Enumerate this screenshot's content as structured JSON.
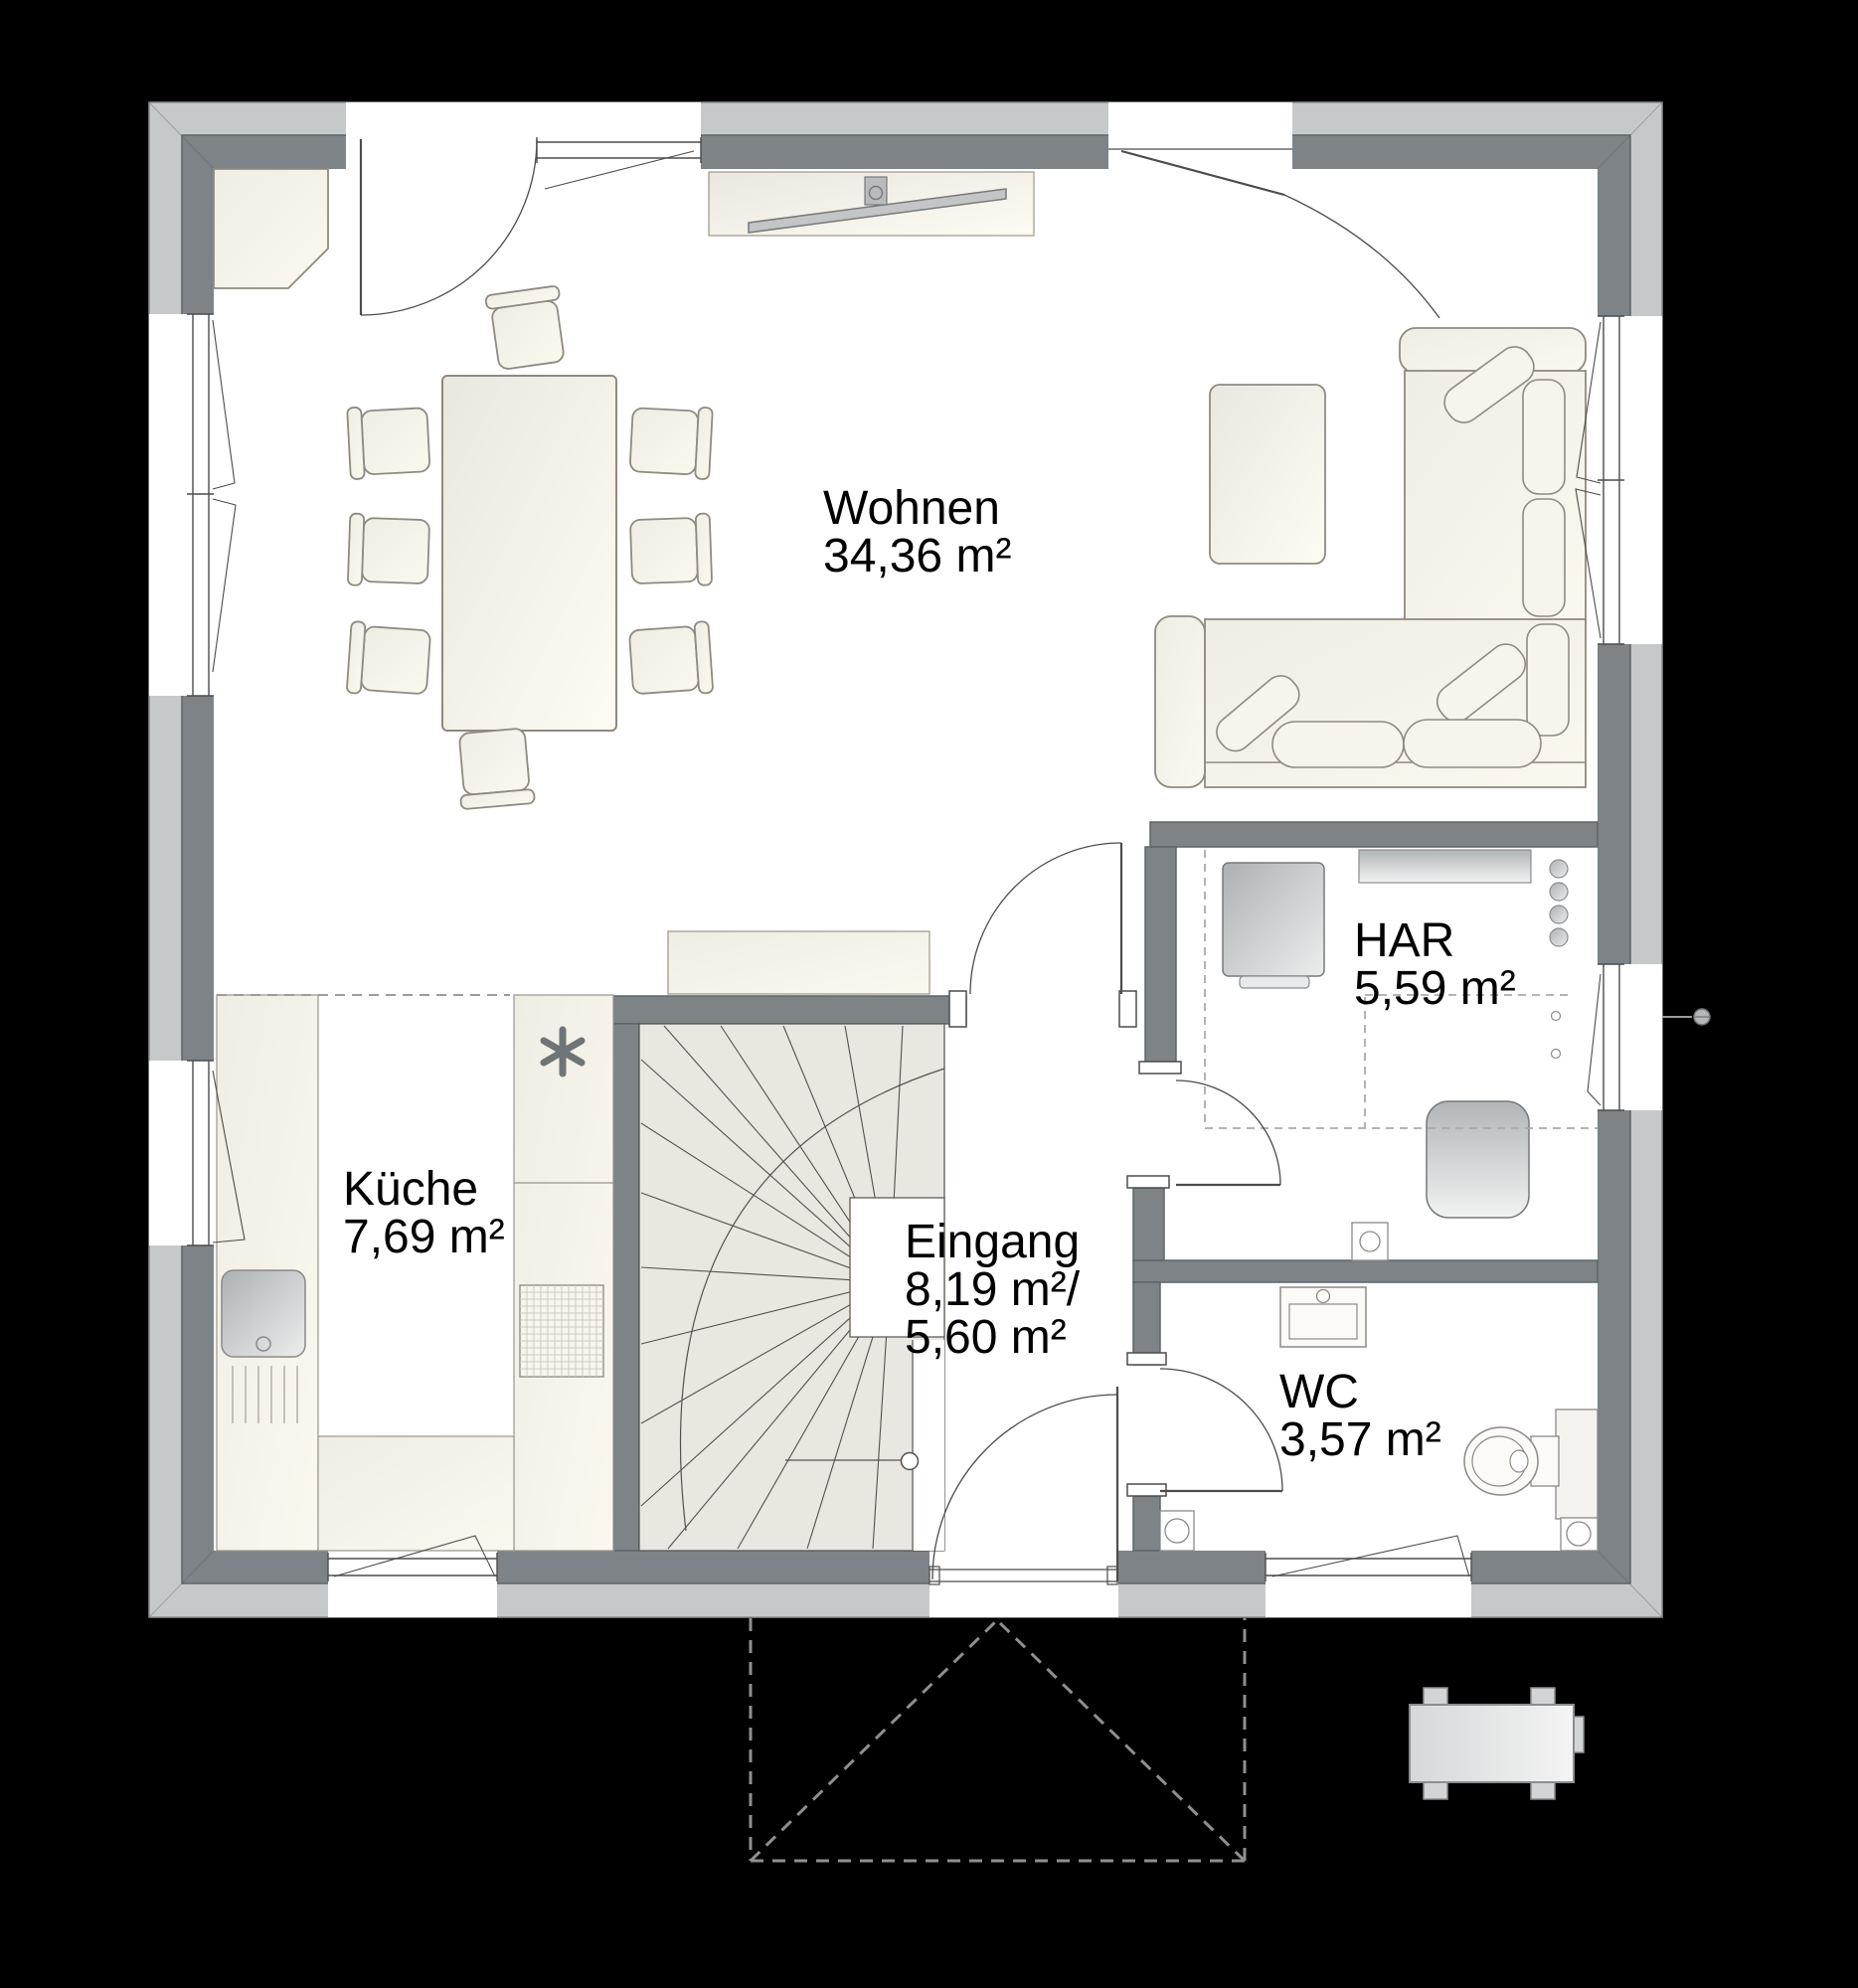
{
  "plan": {
    "type": "floor-plan-ground-floor",
    "rooms": [
      {
        "id": "wohnen",
        "name": "Wohnen",
        "area": "34,36 m²"
      },
      {
        "id": "kueche",
        "name": "Küche",
        "area": "7,69 m²"
      },
      {
        "id": "eingang",
        "name": "Eingang",
        "area_with_stairs": "8,19 m²/",
        "area_without_stairs": "5,60 m²"
      },
      {
        "id": "har",
        "name": "HAR",
        "area": "5,59 m²"
      },
      {
        "id": "wc",
        "name": "WC",
        "area": "3,57 m²"
      }
    ],
    "icons": {
      "cooktop": "asterisk-symbol",
      "outdoor_tap": "circle-marker"
    },
    "colors": {
      "background": "#000000",
      "wall_outer_band": "#c6c9ca",
      "wall_inner_band": "#7d8387",
      "floor": "#ffffff",
      "furniture_fill": "#f1efe6",
      "furniture_outline": "#8f8a82",
      "stair_fill": "#e9e7e0",
      "appliance_gray": "#b9bcbe",
      "label_text": "#000000"
    }
  }
}
